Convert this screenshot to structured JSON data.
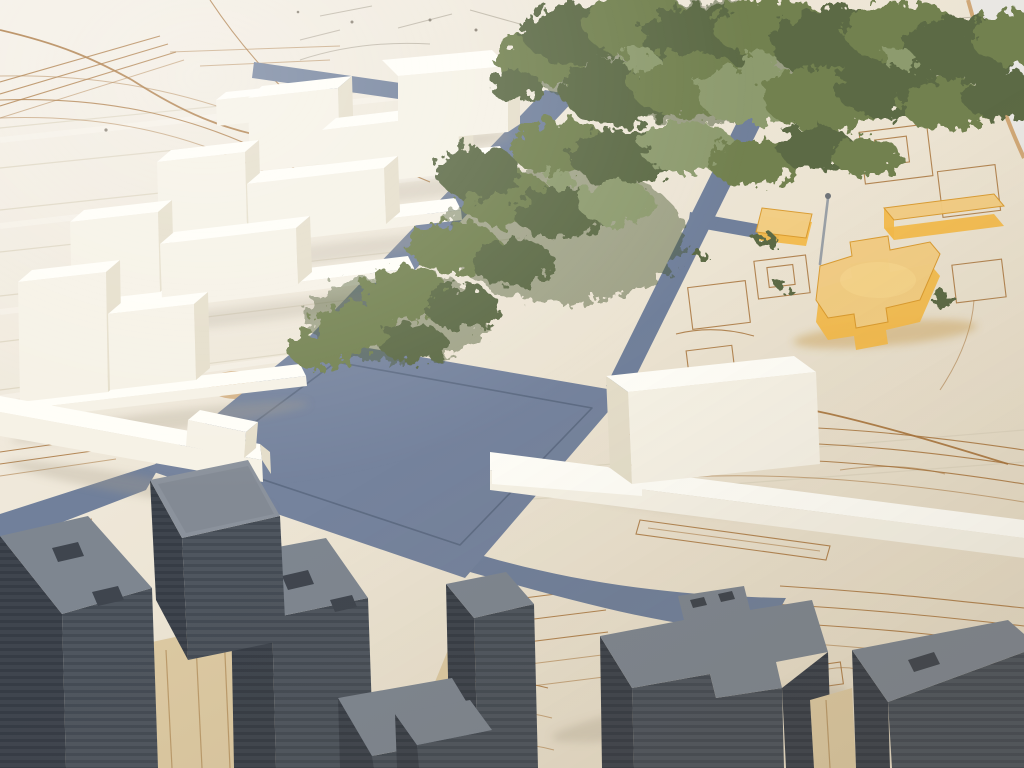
{
  "scene": {
    "type": "photograph",
    "subject": "architectural-scale-model",
    "elements": [
      "laser-etched-site-base",
      "white-foam-stepped-buildings",
      "white-foam-cube-building",
      "white-foam-slab-building",
      "white-plinth-strips",
      "blue-paper-road-network",
      "blue-paper-plaza",
      "green-moss-model-trees",
      "amber-resin-landmark-building",
      "metal-marker-pin",
      "gray-stacked-card-buildings",
      "wood-infill-strips",
      "etched-contour-lines",
      "etched-building-footprints"
    ]
  },
  "colors": {
    "base_a": "#f4efe5",
    "base_b": "#ece4d3",
    "base_c": "#e6dcc6",
    "plank_highlight": "#f9f6ee",
    "plank_seam": "#dcd3be",
    "pencil": "#b4ac9c",
    "pencil_dark": "#8a8274",
    "etch": "#a8743c",
    "burn": "#c9995f",
    "table": "#e9e7e3",
    "road": "#71809b",
    "road_dark": "#5c6a82",
    "plaza": "#75839d",
    "plaza_line": "#515f77",
    "white_top": "#fffef8",
    "white_front": "#f6f2e6",
    "white_side": "#e5deca",
    "white_cream": "#efe9d6",
    "gray_top": "#7e8690",
    "gray_top_light": "#8b929c",
    "gray_side": "#4f565f",
    "gray_stripe": "#444b54",
    "gray_side_dark": "#3f454e",
    "gray_deep": "#363c45",
    "moss": "#72814f",
    "moss_dark": "#5c6b45",
    "moss_light": "#8d9b6e",
    "moss_deep": "#46532f",
    "orange_top": "#f2cd83",
    "orange_side": "#f3ba4c",
    "orange_glow": "#f8d88f",
    "orange_edge": "#d99a2e",
    "orange_shadow": "#c99f55",
    "pin": "#9aa0a6",
    "pin_dark": "#6f7479",
    "wood": "#dcc9a2",
    "wood_line": "#b3905e",
    "shadow": "#a89f8a"
  }
}
